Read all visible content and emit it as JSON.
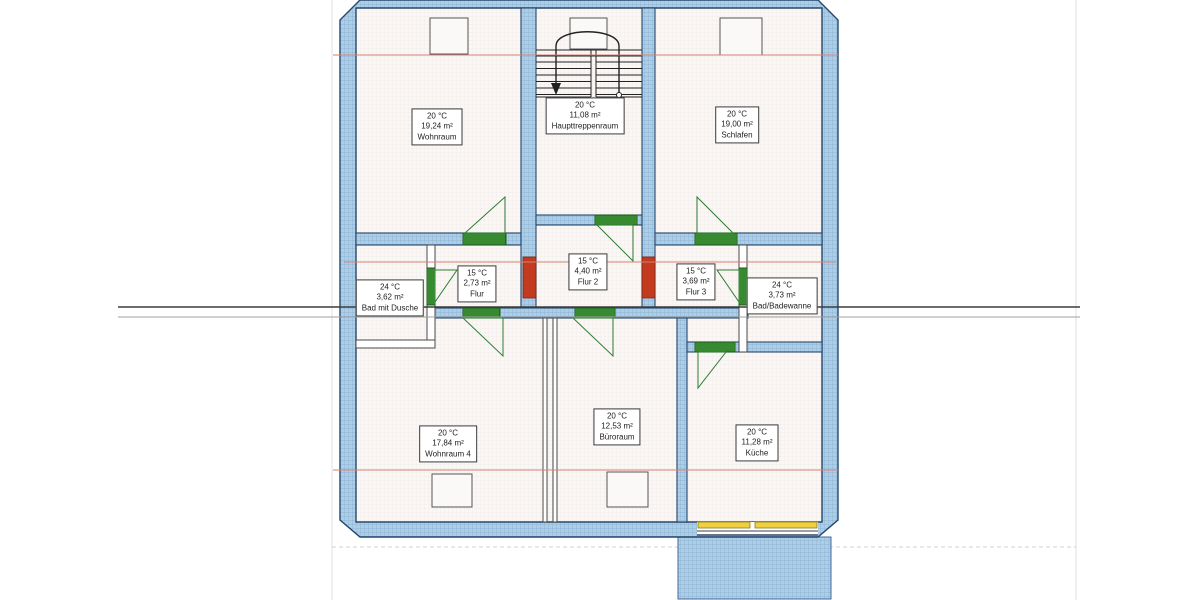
{
  "drawing_type": "floor-plan-with-room-heating-data",
  "rooms": [
    {
      "id": "wohnraum",
      "temperature": "20 °C",
      "area": "19,24 m²",
      "name": "Wohnraum"
    },
    {
      "id": "haupttreppenraum",
      "temperature": "20 °C",
      "area": "11,08 m²",
      "name": "Haupttreppenraum"
    },
    {
      "id": "schlafen",
      "temperature": "20 °C",
      "area": "19,00 m²",
      "name": "Schlafen"
    },
    {
      "id": "flur",
      "temperature": "15 °C",
      "area": "2,73 m²",
      "name": "Flur"
    },
    {
      "id": "flur-2",
      "temperature": "15 °C",
      "area": "4,40 m²",
      "name": "Flur 2"
    },
    {
      "id": "flur-3",
      "temperature": "15 °C",
      "area": "3,69 m²",
      "name": "Flur 3"
    },
    {
      "id": "bad-mit-dusche",
      "temperature": "24 °C",
      "area": "3,62 m²",
      "name": "Bad mit Dusche"
    },
    {
      "id": "bad-badewanne",
      "temperature": "24 °C",
      "area": "3,73 m²",
      "name": "Bad/Badewanne"
    },
    {
      "id": "wohnraum-4",
      "temperature": "20 °C",
      "area": "17,84 m²",
      "name": "Wohnraum 4"
    },
    {
      "id": "bueroraum",
      "temperature": "20 °C",
      "area": "12,53 m²",
      "name": "Büroraum"
    },
    {
      "id": "kueche",
      "temperature": "20 °C",
      "area": "11,28 m²",
      "name": "Küche"
    }
  ],
  "legend_colors": {
    "wall_fill": "#aecde6",
    "door_marker": "#4aa43e",
    "window_marker": "#f0d040",
    "opening_marker": "#c23b1e",
    "reference_line_red": "#d4826e",
    "section_line_dark": "#3c3c3c",
    "section_line_light": "#a0a0a0"
  }
}
